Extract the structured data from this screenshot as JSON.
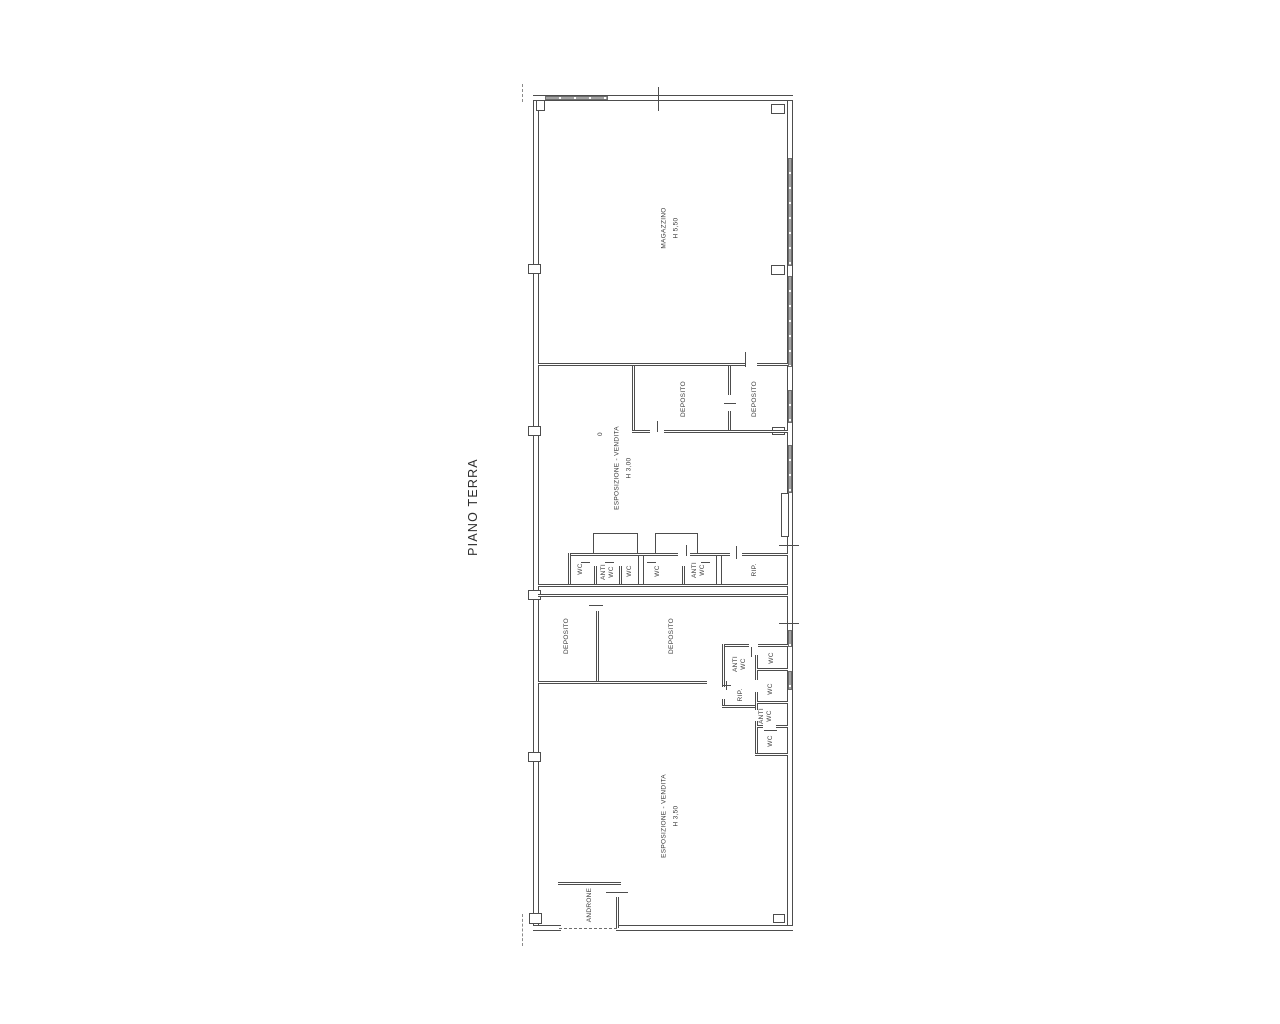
{
  "title": {
    "text": "PIANO TERRA"
  },
  "rooms": {
    "magazzino": {
      "name": "MAGAZZINO",
      "height": "H 5,50"
    },
    "esposizione_mid": {
      "name": "ESPOSIZIONE - VENDITA",
      "height": "H 3,00"
    },
    "esposizione_low": {
      "name": "ESPOSIZIONE - VENDITA",
      "height": "H 3,50"
    },
    "deposito_mid_1": {
      "name": "DEPOSITO"
    },
    "deposito_mid_2": {
      "name": "DEPOSITO"
    },
    "deposito_low_1": {
      "name": "DEPOSITO"
    },
    "deposito_low_2": {
      "name": "DEPOSITO"
    },
    "androne": {
      "name": "ANDRONE"
    },
    "wc_band": {
      "wc1": "WC",
      "anti1_l1": "ANTI",
      "anti1_l2": "WC",
      "wc2": "WC",
      "wc3": "WC",
      "anti2_l1": "ANTI",
      "anti2_l2": "WC",
      "rip": "RIP."
    },
    "wc_cluster": {
      "anti_top_l1": "ANTI",
      "anti_top_l2": "WC",
      "wc_top": "WC",
      "rip": "RIP.",
      "wc_mid": "WC",
      "anti_low_l1": "ANTI",
      "anti_low_l2": "WC",
      "wc_bottom": "WC"
    }
  },
  "annotations": {
    "zero_mark": "0"
  }
}
